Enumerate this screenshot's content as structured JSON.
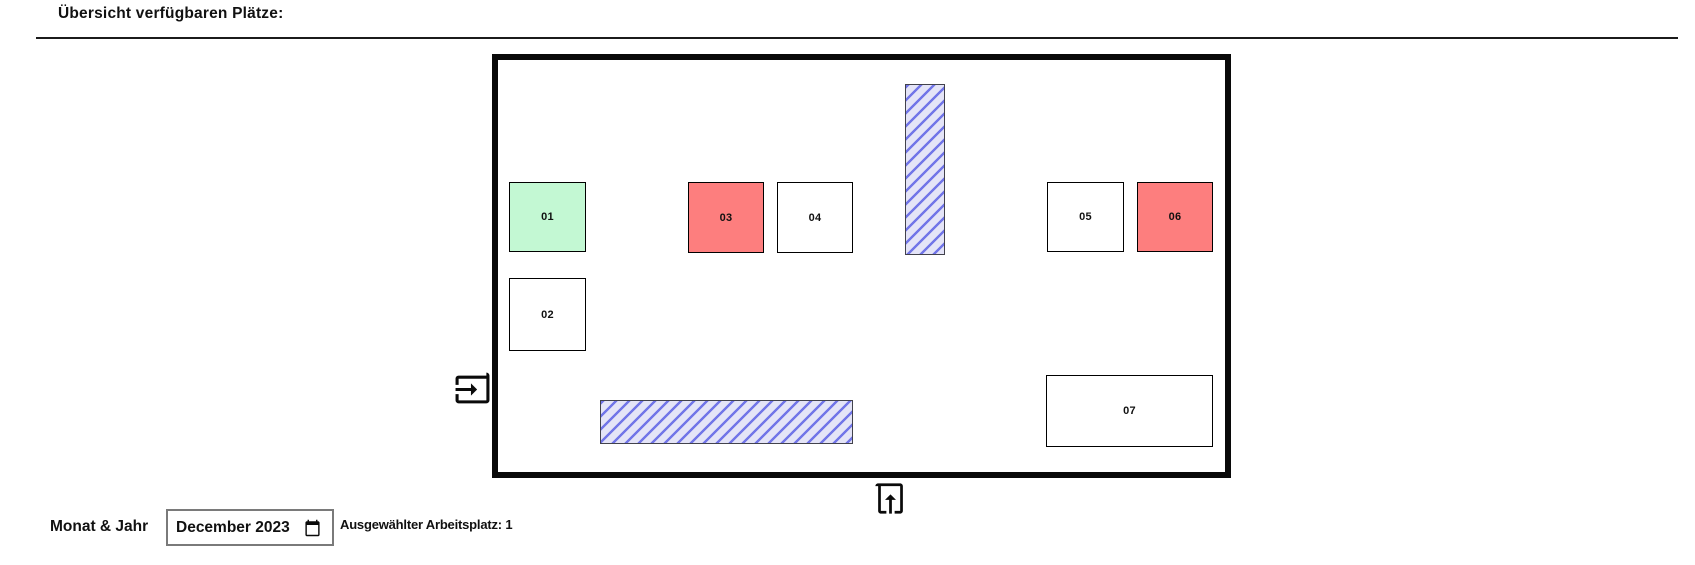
{
  "header": {
    "title": "Übersicht verfügbaren Plätze:"
  },
  "room": {
    "seats": [
      {
        "id": "01",
        "label": "01",
        "status": "selected"
      },
      {
        "id": "02",
        "label": "02",
        "status": "free"
      },
      {
        "id": "03",
        "label": "03",
        "status": "occupied"
      },
      {
        "id": "04",
        "label": "04",
        "status": "free"
      },
      {
        "id": "05",
        "label": "05",
        "status": "free"
      },
      {
        "id": "06",
        "label": "06",
        "status": "occupied"
      },
      {
        "id": "07",
        "label": "07",
        "status": "free"
      }
    ],
    "status_colors": {
      "selected": "#c3f8d3",
      "occupied": "#fd7e7e",
      "free": "#ffffff"
    },
    "hatch_colors": {
      "background": "#e4e4f7",
      "stripe": "#7276e8"
    },
    "wall_color": "#090909"
  },
  "icons": {
    "entry_left": "door-entry-arrow-right-icon",
    "entry_bottom": "door-entry-arrow-up-icon",
    "calendar": "calendar-icon"
  },
  "footer": {
    "month_label": "Monat & Jahr",
    "month_value": "December 2023",
    "selected_workspace_text": "Ausgewählter Arbeitsplatz: 1"
  }
}
